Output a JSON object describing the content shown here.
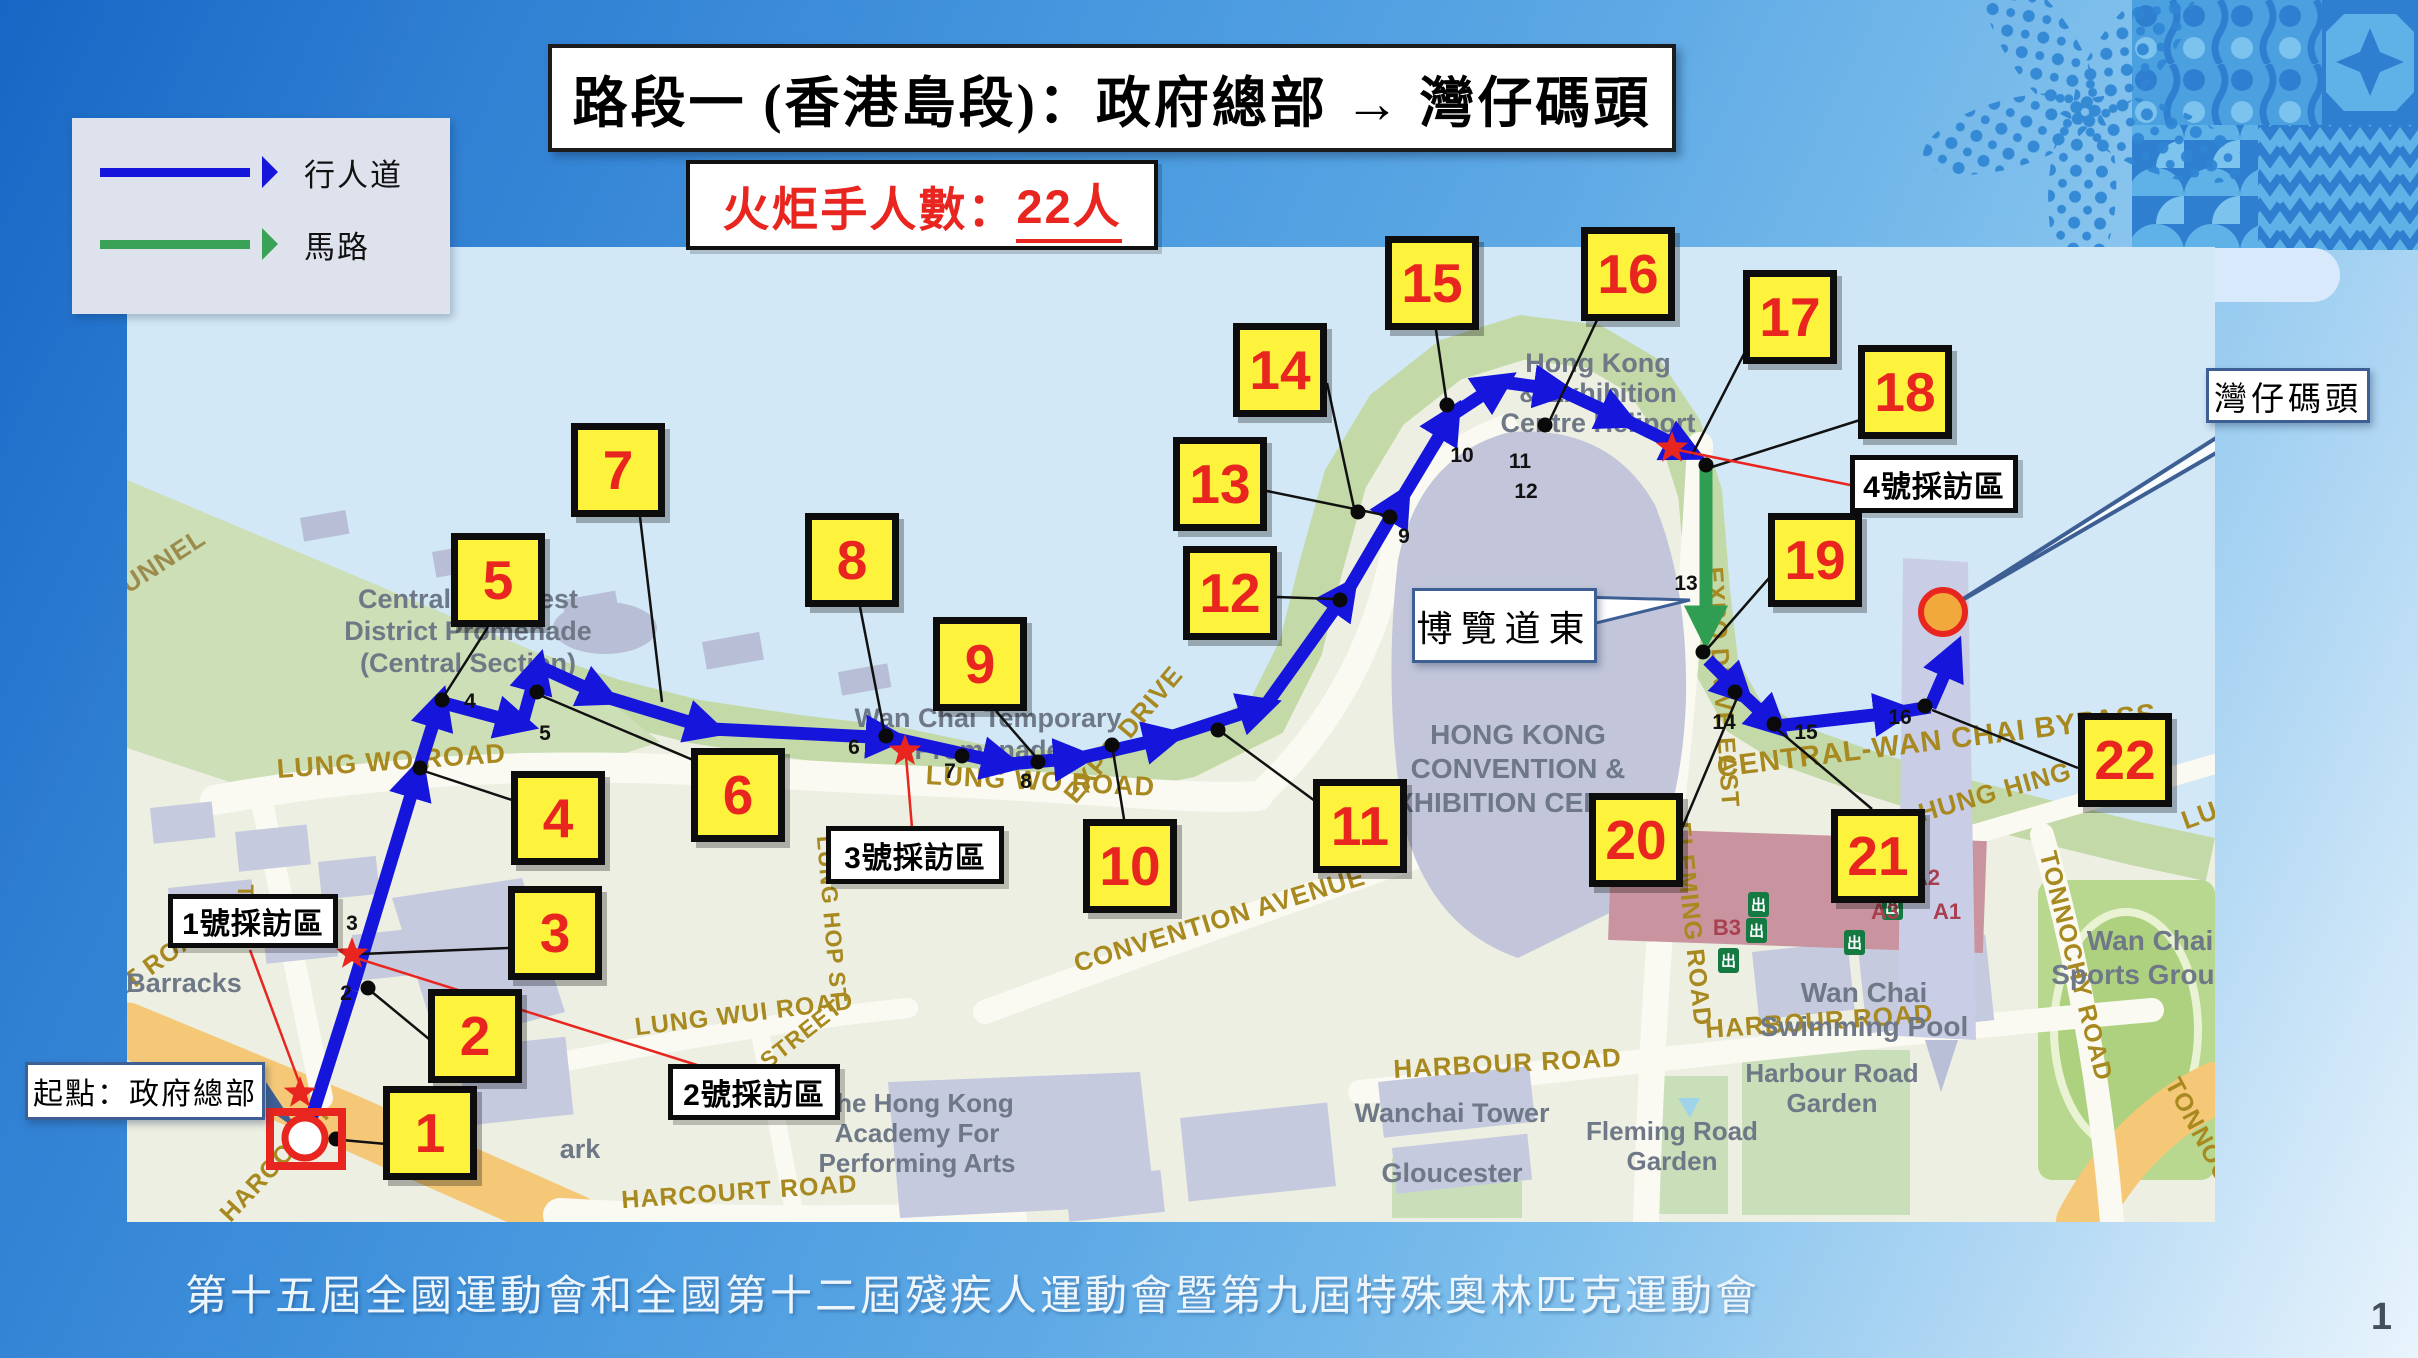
{
  "header": {
    "title": "路段一 (香港島段)：政府總部 → 灣仔碼頭",
    "torchbearer_label": {
      "prefix": "火炬手人數：",
      "count": "22",
      "suffix": "人"
    }
  },
  "legend": {
    "items": [
      {
        "label": "行人道",
        "type": "pedestrian-path",
        "color": "#1515dc"
      },
      {
        "label": "馬路",
        "type": "road",
        "color": "#3aa257"
      }
    ]
  },
  "route": {
    "section_markers": [
      "1",
      "2",
      "3",
      "4",
      "5",
      "6",
      "7",
      "8",
      "9",
      "10",
      "11",
      "12",
      "13",
      "14",
      "15",
      "16",
      "17",
      "18",
      "19",
      "20",
      "21",
      "22"
    ],
    "waypoint_numbers": [
      "2",
      "3",
      "4",
      "5",
      "6",
      "7",
      "8",
      "9",
      "10",
      "11",
      "12",
      "13",
      "14",
      "15",
      "16"
    ],
    "start_callout": "起點：政府總部",
    "end_callout": "灣仔碼頭",
    "road_callout": "博覽道東",
    "interview_zones": [
      "1號採訪區",
      "2號採訪區",
      "3號採訪區",
      "4號採訪區"
    ],
    "colors": {
      "pedestrian_path": "#1515dc",
      "road_path": "#2f9e53",
      "marker_fill": "#fdf23c",
      "marker_number": "#e8251f",
      "interview_star": "#e8251f"
    }
  },
  "map": {
    "road_labels": [
      {
        "id": "ss-tunnel",
        "text": "SS TUNNEL"
      },
      {
        "id": "harcourt-1",
        "text": "HARCOURT ROAD"
      },
      {
        "id": "harcourt-2",
        "text": "HARCOURT"
      },
      {
        "id": "harcourt-3",
        "text": "HARCOURT ROAD"
      },
      {
        "id": "tim-mei",
        "text": "TIM"
      },
      {
        "id": "lung-wo-1",
        "text": "LUNG WO ROAD"
      },
      {
        "id": "lung-wui",
        "text": "LUNG WUI ROAD"
      },
      {
        "id": "street",
        "text": "STREET"
      },
      {
        "id": "lung-hop",
        "text": "LUNG HOP ST"
      },
      {
        "id": "lung-wo-2",
        "text": "LUNG WO ROAD"
      },
      {
        "id": "expo-drive",
        "text": "EXPO DRIVE"
      },
      {
        "id": "expo-drive-east",
        "text": "EXPO DRIVE EAST"
      },
      {
        "id": "convention-ave",
        "text": "CONVENTION AVENUE"
      },
      {
        "id": "harbour-road-1",
        "text": "HARBOUR ROAD"
      },
      {
        "id": "harbour-road-2",
        "text": "HARBOUR ROAD"
      },
      {
        "id": "fleming-road",
        "text": "FLEMING ROAD"
      },
      {
        "id": "central-bypass",
        "text": "CENTRAL-WAN CHAI BYPASS"
      },
      {
        "id": "hung-hing",
        "text": "HUNG HING ROAD"
      },
      {
        "id": "lung-hing",
        "text": "LUNG HING ROAD"
      },
      {
        "id": "tonnochy-1",
        "text": "TONNOCHY ROAD"
      },
      {
        "id": "tonnochy-2",
        "text": "TONNOCHY"
      }
    ],
    "place_labels": [
      {
        "id": "promenade",
        "lines": [
          "Central and West",
          "District Promenade",
          "(Central Section)"
        ]
      },
      {
        "id": "barracks",
        "lines": [
          "Barracks"
        ]
      },
      {
        "id": "tamar-park",
        "lines": [
          "ark"
        ]
      },
      {
        "id": "wanchai-temp",
        "lines": [
          "Wan Chai Temporary",
          "Promenade"
        ]
      },
      {
        "id": "hkcec",
        "lines": [
          "HONG KONG",
          "CONVENTION &",
          "EXHIBITION CENTRE"
        ]
      },
      {
        "id": "heliport",
        "lines": [
          "Hong Kong",
          "& Exhibition",
          "Centre Heliport"
        ]
      },
      {
        "id": "wanchai-tower",
        "lines": [
          "Wanchai Tower"
        ]
      },
      {
        "id": "gloucester",
        "lines": [
          "Gloucester"
        ]
      },
      {
        "id": "apa",
        "lines": [
          "The Hong Kong",
          "Academy For",
          "Performing Arts"
        ]
      },
      {
        "id": "swimming-pool",
        "lines": [
          "Wan Chai",
          "Swimming Pool"
        ]
      },
      {
        "id": "sports-ground",
        "lines": [
          "Wan Chai",
          "Sports Ground"
        ]
      },
      {
        "id": "harbour-garden",
        "lines": [
          "Harbour Road",
          "Garden"
        ]
      },
      {
        "id": "fleming-garden",
        "lines": [
          "Fleming Road",
          "Garden"
        ]
      }
    ],
    "exit_labels": [
      "B3",
      "A3",
      "A2",
      "A1"
    ],
    "exit_icon": "出"
  },
  "footer": {
    "event_title": "第十五屆全國運動會和全國第十二屆殘疾人運動會暨第九屆特殊奧林匹克運動會",
    "page_number": "1"
  }
}
